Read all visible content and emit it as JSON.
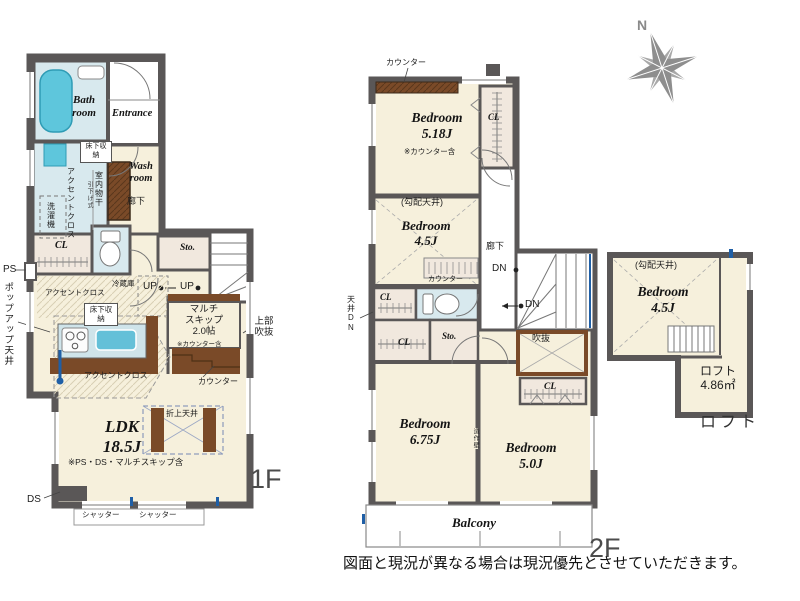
{
  "colors": {
    "wall": "#5a5757",
    "room_cream": "#f6f0dc",
    "water_blue": "#d8e9ee",
    "bathtub_cyan": "#5ec6dc",
    "wood_brown": "#7a4a28",
    "closet_beige": "#f1e8de",
    "accent_blue": "#1f5fa6",
    "compass_gray": "#8e8e8e"
  },
  "floor1": {
    "floor_label": "1F",
    "bath_room": "Bath room",
    "entrance": "Entrance",
    "wash_room": "Wash room",
    "underfloor_storage_top": "床下収納",
    "accent_cloth_wash": "アクセントクロス",
    "indoor_clothes_drying": "室内物干",
    "pull_down_type": "引下げ式",
    "washing_machine": "洗濯機",
    "hallway": "廊下",
    "closet": "CL",
    "pipe_space": "PS",
    "popup_ceiling": "ポップアップ天井",
    "accent_cloth_kitchen": "アクセントクロス",
    "refrigerator": "冷蔵庫",
    "underfloor_storage_kitchen": "床下収納",
    "up_label_1": "UP",
    "up_label_2": "UP",
    "storage": "Sto.",
    "multi_skip_line1": "マルチ",
    "multi_skip_line2": "スキップ",
    "multi_skip_size": "2.0帖",
    "multi_skip_note": "※カウンター含",
    "upper_void": "上部吹抜",
    "counter": "カウンター",
    "accent_cloth_ldk": "アクセントクロス",
    "coffered_ceiling": "折上天井",
    "ldk_name": "LDK",
    "ldk_size": "18.5J",
    "ldk_note": "※PS・DS・マルチスキップ含",
    "duct_space": "DS",
    "shutter_1": "シャッター",
    "shutter_2": "シャッター"
  },
  "floor2": {
    "floor_label": "2F",
    "counter_top": "カウンター",
    "bedroom1_name": "Bedroom",
    "bedroom1_size": "5.18J",
    "bedroom1_note": "※カウンター含",
    "closet1": "CL",
    "sloped_ceiling": "(勾配天井)",
    "bedroom2_name": "Bedroom",
    "bedroom2_size": "4.5J",
    "hallway": "廊下",
    "down_label_1": "DN",
    "counter_mid": "カウンター",
    "down_label_2": "DN",
    "closet2": "CL",
    "closet3": "CL",
    "storage": "Sto.",
    "void": "吹抜",
    "ceiling_down": "天井DN",
    "bedroom3_name": "Bedroom",
    "bedroom3_size": "6.75J",
    "partition_wall": "造作壁",
    "bedroom4_name": "Bedroom",
    "bedroom4_size": "5.0J",
    "closet4": "CL",
    "balcony": "Balcony"
  },
  "loft": {
    "sloped_ceiling": "(勾配天井)",
    "bedroom_name": "Bedroom",
    "bedroom_size": "4.5J",
    "loft_name": "ロフト",
    "loft_area": "4.86㎡",
    "big_label": "ロフト"
  },
  "compass": {
    "north": "N"
  },
  "footer": {
    "disclaimer": "図面と現況が異なる場合は現況優先とさせていただきます。"
  }
}
